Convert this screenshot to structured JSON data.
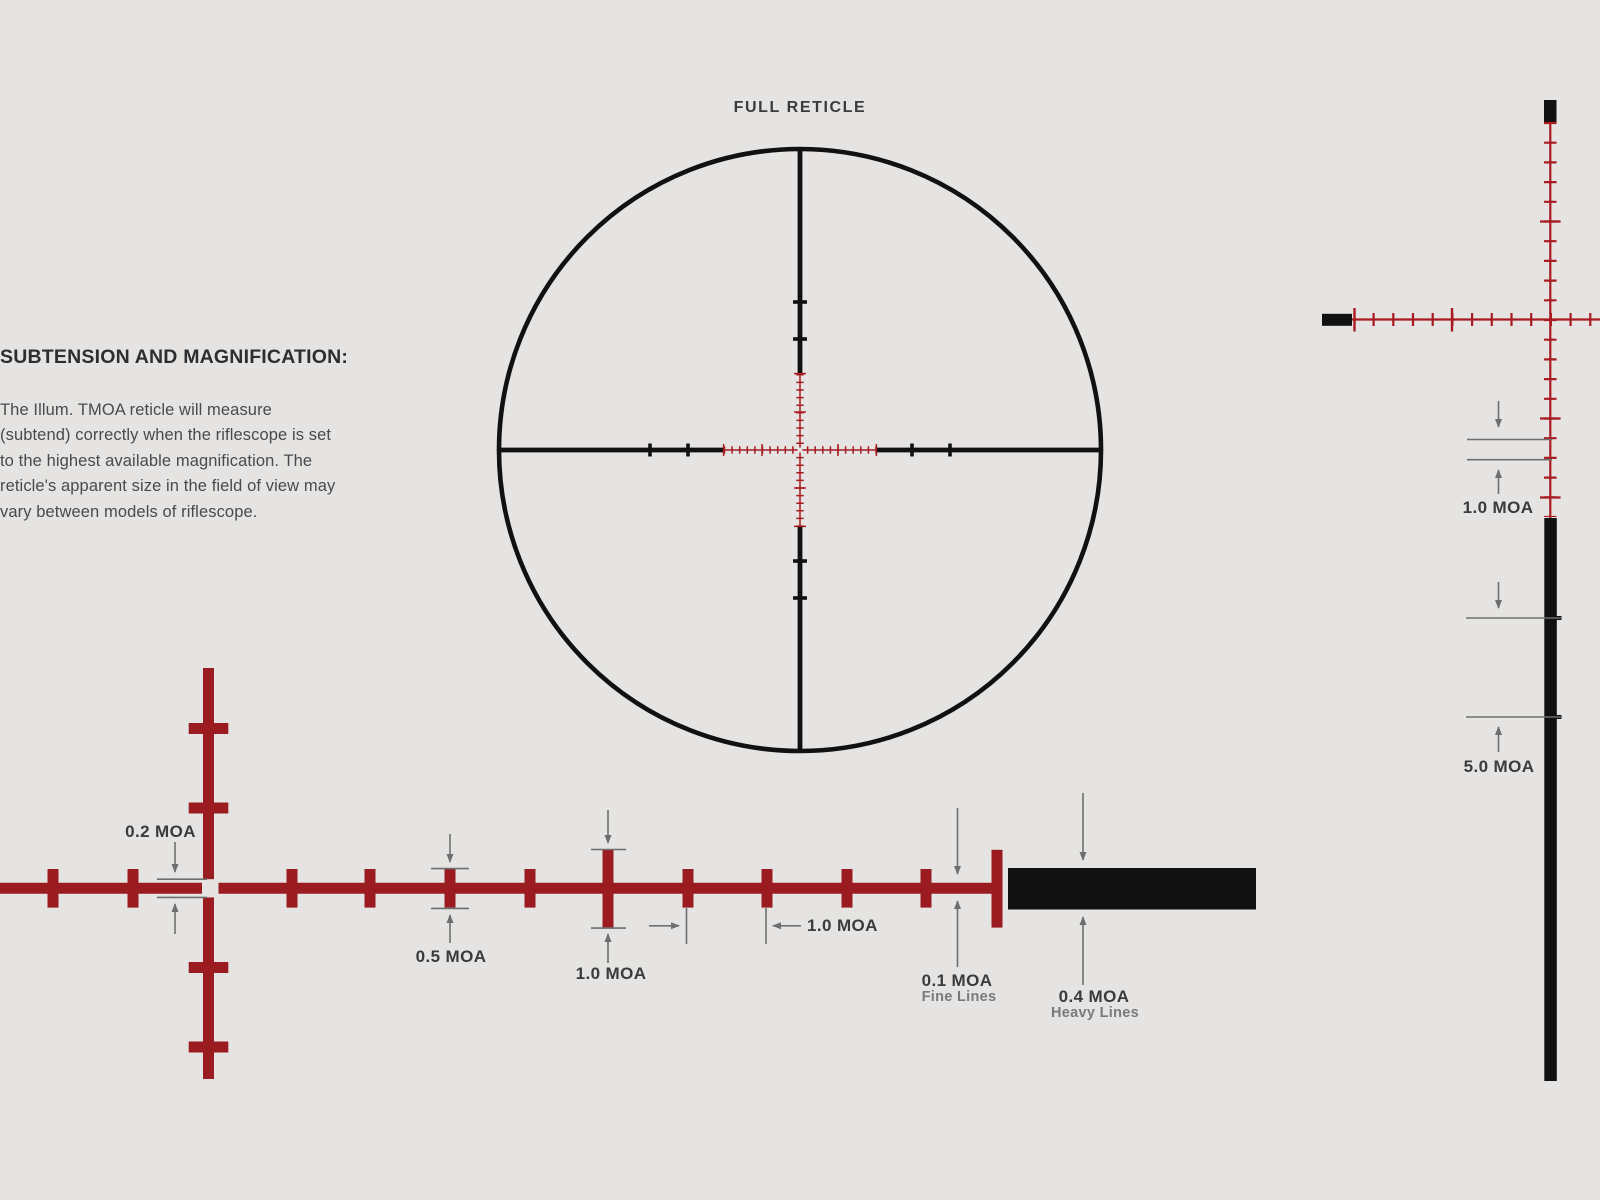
{
  "full_reticle": {
    "title": "FULL RETICLE"
  },
  "info_panel": {
    "heading": "SUBTENSION AND MAGNIFICATION:",
    "lines": [
      "The Illum. TMOA reticle will measure",
      "(subtend) correctly when the riflescope is set",
      "to the highest available magnification. The",
      "reticle's apparent size in the field of view may",
      "vary between models of riflescope."
    ]
  },
  "center_detail": {
    "center_gap_label": "0.2 MOA",
    "half_tick_label": "0.5 MOA",
    "tall_tick_label": "1.0 MOA",
    "tick_spacing_label": "1.0 MOA",
    "fine_line_label": "0.1 MOA",
    "fine_line_sublabel": "Fine Lines",
    "heavy_line_label": "0.4 MOA",
    "heavy_line_sublabel": "Heavy Lines"
  },
  "side_detail": {
    "tick_spacing_label": "1.0 MOA",
    "post_interval_label": "5.0 MOA"
  },
  "colors": {
    "background": "#e5e4e2",
    "reticle_black": "#111111",
    "detail_red": "#9a1b20",
    "side_red": "#a81b20",
    "annotation_gray": "#6e6e6e",
    "label_dark": "#3b3b3b",
    "label_gray": "#7a7a7a"
  }
}
